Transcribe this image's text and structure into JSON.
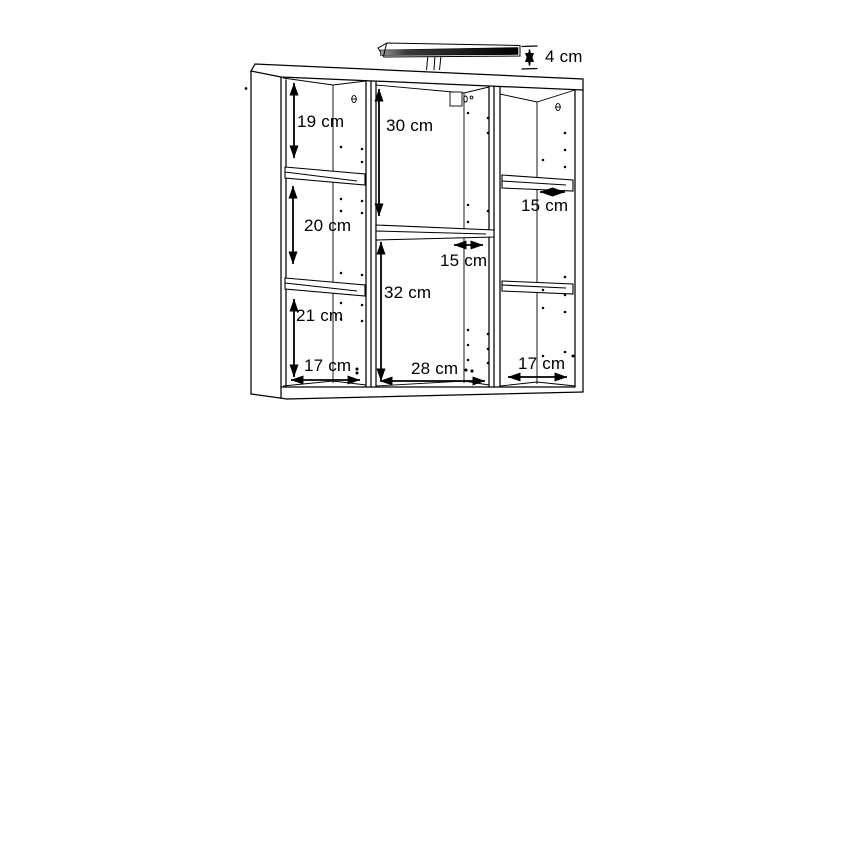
{
  "diagram": {
    "type": "furniture-dimension-drawing",
    "subject": "wall mirror cabinet with top light bar, three sections and open shelves",
    "unit": "cm",
    "labels": {
      "light_height": "4 cm",
      "left_section_top": "19 cm",
      "left_section_middle": "20 cm",
      "left_section_bottom": "21 cm",
      "center_section_top": "30 cm",
      "center_section_bottom": "32 cm",
      "center_shelf_depth": "15 cm",
      "right_shelf_depth": "15 cm",
      "left_section_width": "17 cm",
      "center_section_width": "28 cm",
      "right_section_width": "17 cm"
    },
    "colors": {
      "line": "#000000",
      "background": "#ffffff",
      "light_bar_dark": "#1a1a1a"
    }
  }
}
